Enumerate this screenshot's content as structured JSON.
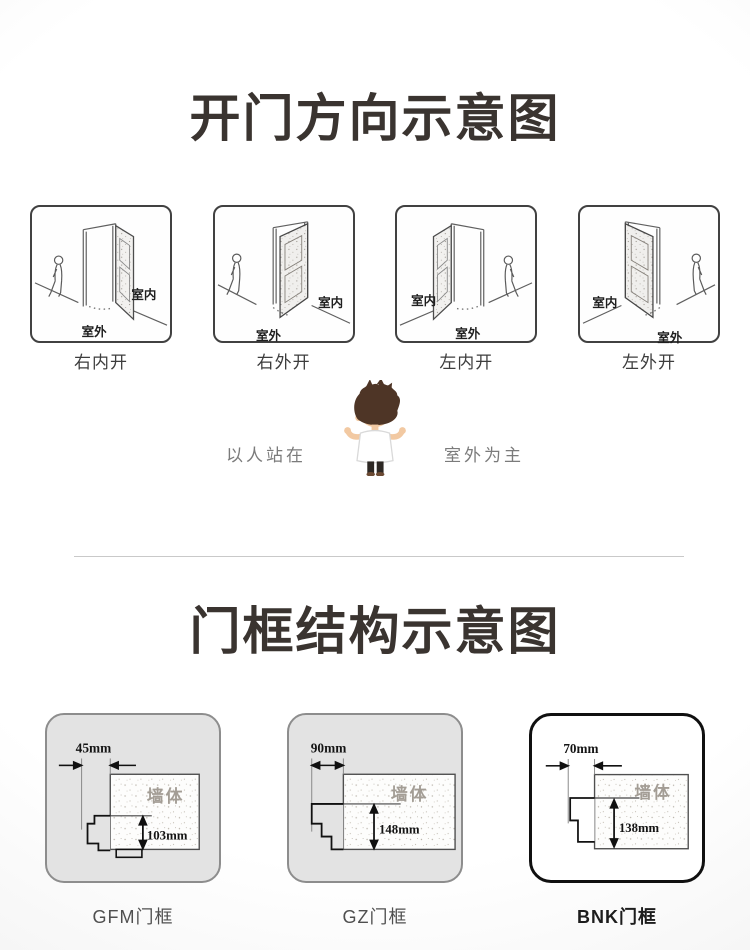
{
  "page": {
    "title_color": "#3a3430",
    "divider_color": "#c9c9c9",
    "highlight_border_color": "#101010"
  },
  "door_section": {
    "title": "开门方向示意图",
    "note_left": "以人站在",
    "note_right": "室外为主",
    "boxes": [
      {
        "caption": "右内开",
        "indoor_label": "室内",
        "outdoor_label": "室外"
      },
      {
        "caption": "右外开",
        "indoor_label": "室内",
        "outdoor_label": "室外"
      },
      {
        "caption": "左内开",
        "indoor_label": "室内",
        "outdoor_label": "室外"
      },
      {
        "caption": "左外开",
        "indoor_label": "室内",
        "outdoor_label": "室外"
      }
    ]
  },
  "frame_section": {
    "title": "门框结构示意图",
    "frames": [
      {
        "caption": "GFM门框",
        "width_label": "45mm",
        "depth_label": "103mm",
        "wall_label": "墙体",
        "highlighted": false
      },
      {
        "caption": "GZ门框",
        "width_label": "90mm",
        "depth_label": "148mm",
        "wall_label": "墙体",
        "highlighted": false
      },
      {
        "caption": "BNK门框",
        "width_label": "70mm",
        "depth_label": "138mm",
        "wall_label": "墙体",
        "highlighted": true
      }
    ]
  }
}
